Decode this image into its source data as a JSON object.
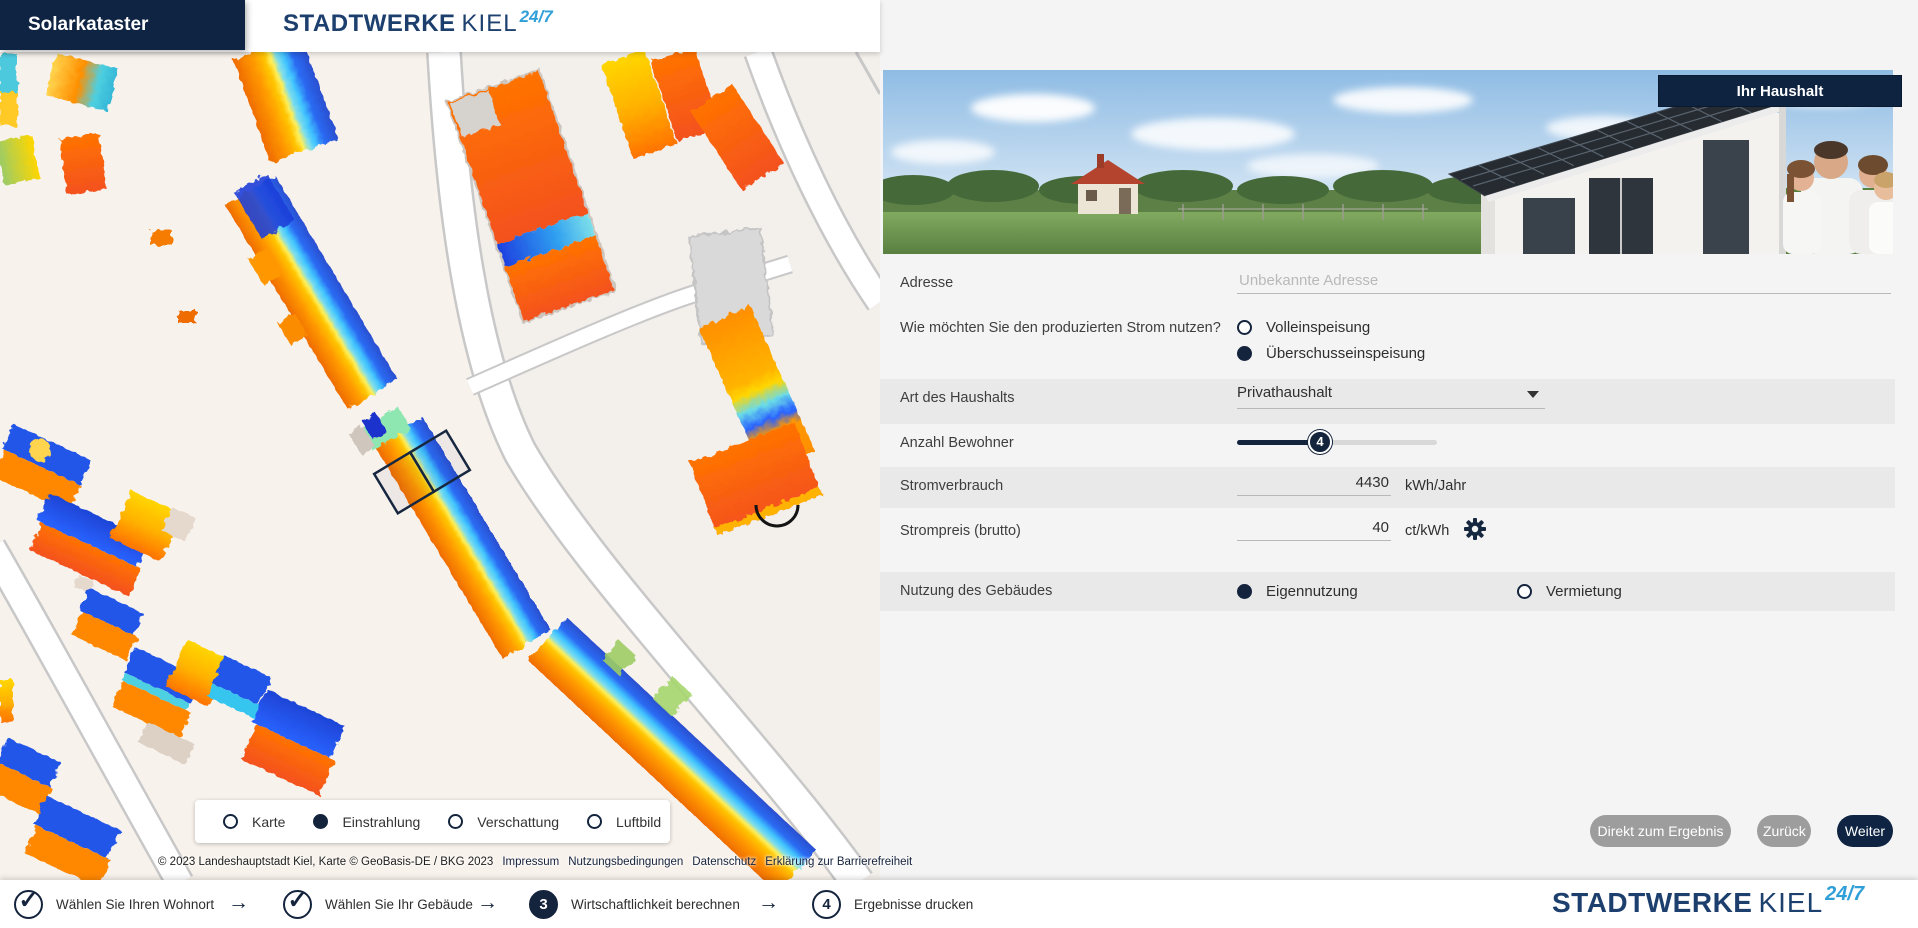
{
  "app": {
    "title": "Solarkataster"
  },
  "brand": {
    "bold": "STADTWERKE",
    "light": "KIEL",
    "sup": "24/7"
  },
  "colors": {
    "navy": "#0e2442",
    "accent_blue": "#2f9fd8",
    "stripe": "#e9e9e9",
    "panel_bg": "#f4f4f4",
    "button_gray": "#9d9d9d",
    "map_high": "#ff6d00",
    "map_low": "#2962ff"
  },
  "map": {
    "layers": [
      {
        "label": "Karte",
        "selected": false
      },
      {
        "label": "Einstrahlung",
        "selected": true
      },
      {
        "label": "Verschattung",
        "selected": false
      },
      {
        "label": "Luftbild",
        "selected": false
      }
    ],
    "copyright": "© 2023 Landeshauptstadt Kiel, Karte © GeoBasis-DE / BKG 2023",
    "links": [
      "Impressum",
      "Nutzungsbedingungen",
      "Datenschutz",
      "Erklärung zur Barrierefreiheit"
    ]
  },
  "panel": {
    "badge": "Ihr Haushalt",
    "fields": {
      "address": {
        "label": "Adresse",
        "placeholder": "Unbekannte Adresse",
        "value": ""
      },
      "usage_question": {
        "label": "Wie möchten Sie den produzierten Strom nutzen?",
        "options": [
          {
            "label": "Volleinspeisung",
            "selected": false
          },
          {
            "label": "Überschusseinspeisung",
            "selected": true
          }
        ]
      },
      "household_type": {
        "label": "Art des Haushalts",
        "value": "Privathaushalt"
      },
      "residents": {
        "label": "Anzahl Bewohner",
        "value": "4"
      },
      "consumption": {
        "label": "Stromverbrauch",
        "value": "4430",
        "unit": "kWh/Jahr"
      },
      "price": {
        "label": "Strompreis (brutto)",
        "value": "40",
        "unit": "ct/kWh"
      },
      "building_use": {
        "label": "Nutzung des Gebäudes",
        "options": [
          {
            "label": "Eigennutzung",
            "selected": true
          },
          {
            "label": "Vermietung",
            "selected": false
          }
        ]
      }
    },
    "buttons": {
      "direct": "Direkt zum Ergebnis",
      "back": "Zurück",
      "next": "Weiter"
    }
  },
  "stepper": {
    "check": "✓",
    "arrow": "→",
    "steps": [
      {
        "num": "",
        "label": "Wählen Sie Ihren Wohnort",
        "state": "done"
      },
      {
        "num": "",
        "label": "Wählen Sie Ihr Gebäude",
        "state": "done"
      },
      {
        "num": "3",
        "label": "Wirtschaftlichkeit berechnen",
        "state": "active"
      },
      {
        "num": "4",
        "label": "Ergebnisse drucken",
        "state": "todo"
      }
    ]
  }
}
